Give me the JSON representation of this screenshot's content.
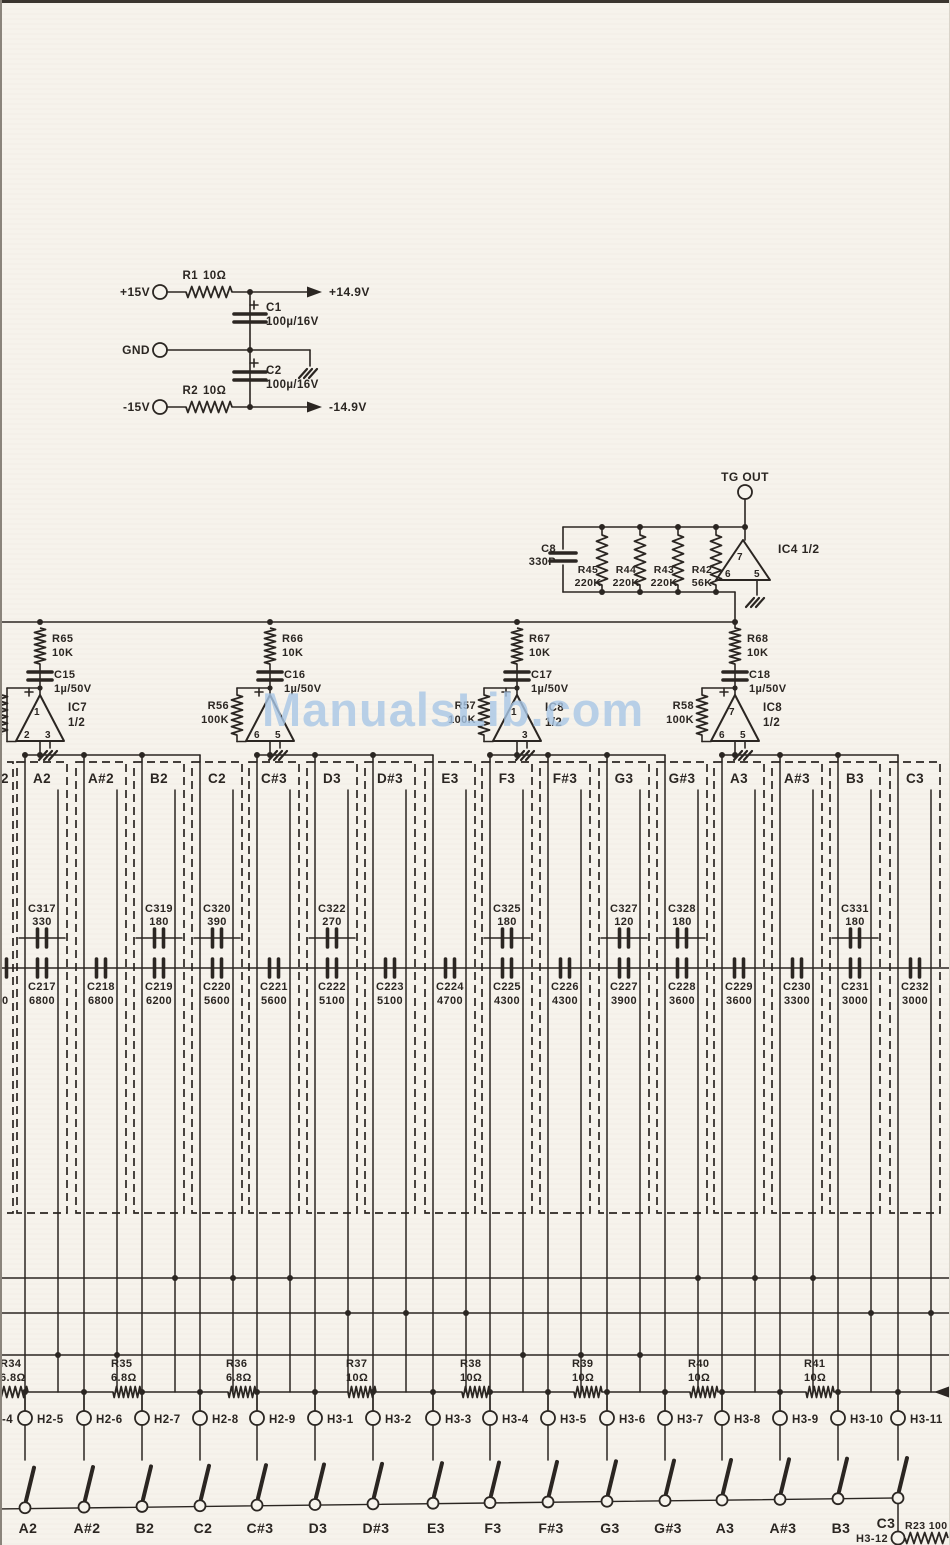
{
  "watermark": {
    "text": "ManualsLib.com"
  },
  "colors": {
    "ink": "#2b2622",
    "paper": "#f6f3ec",
    "watermark": "#a9c7e6"
  },
  "power": {
    "vin_pos": "+15V",
    "vin_gnd": "GND",
    "vin_neg": "-15V",
    "r1_name": "R1",
    "r1_value": "10Ω",
    "r2_name": "R2",
    "r2_value": "10Ω",
    "c1_name": "C1",
    "c1_value": "100µ/16V",
    "c2_name": "C2",
    "c2_value": "100µ/16V",
    "vout_pos": "+14.9V",
    "vout_neg": "-14.9V"
  },
  "tg": {
    "out": "TG OUT",
    "ic": "IC4 1/2",
    "pin_top": "7",
    "pin_bl": "6",
    "pin_br": "5",
    "c8_name": "C8",
    "c8_value": "330P",
    "resistors": [
      [
        "R45",
        "220K"
      ],
      [
        "R44",
        "220K"
      ],
      [
        "R43",
        "220K"
      ],
      [
        "R42",
        "56K"
      ]
    ]
  },
  "stages": [
    {
      "r": "R65",
      "rv": "10K",
      "c": "C15",
      "cv": "1µ/50V",
      "ic": "IC7",
      "half": "1/2",
      "pins": {
        "top": "1",
        "bl": "2",
        "br": "3"
      }
    },
    {
      "r": "R66",
      "rv": "10K",
      "c": "C16",
      "cv": "1µ/50V",
      "fb": "R56",
      "fbv": "100K",
      "pins": {
        "bl": "6",
        "br": "5"
      }
    },
    {
      "r": "R67",
      "rv": "10K",
      "c": "C17",
      "cv": "1µ/50V",
      "fb": "R57",
      "fbv": "100K",
      "ic": "IC8",
      "half": "1/2",
      "pins": {
        "top": "1",
        "br": "3"
      }
    },
    {
      "r": "R68",
      "rv": "10K",
      "c": "C18",
      "cv": "1µ/50V",
      "fb": "R58",
      "fbv": "100K",
      "ic": "IC8",
      "half": "1/2",
      "pins": {
        "top": "7",
        "bl": "6",
        "br": "5"
      }
    }
  ],
  "partial": {
    "note": "2",
    "bottom_value": "0"
  },
  "columns": [
    {
      "note": "A2",
      "top": [
        "C317",
        "330"
      ],
      "bottom": [
        "C217",
        "6800"
      ]
    },
    {
      "note": "A#2",
      "bottom": [
        "C218",
        "6800"
      ]
    },
    {
      "note": "B2",
      "top": [
        "C319",
        "180"
      ],
      "bottom": [
        "C219",
        "6200"
      ]
    },
    {
      "note": "C2",
      "top": [
        "C320",
        "390"
      ],
      "bottom": [
        "C220",
        "5600"
      ]
    },
    {
      "note": "C#3",
      "bottom": [
        "C221",
        "5600"
      ]
    },
    {
      "note": "D3",
      "top": [
        "C322",
        "270"
      ],
      "bottom": [
        "C222",
        "5100"
      ]
    },
    {
      "note": "D#3",
      "bottom": [
        "C223",
        "5100"
      ]
    },
    {
      "note": "E3",
      "bottom": [
        "C224",
        "4700"
      ]
    },
    {
      "note": "F3",
      "top": [
        "C325",
        "180"
      ],
      "bottom": [
        "C225",
        "4300"
      ]
    },
    {
      "note": "F#3",
      "bottom": [
        "C226",
        "4300"
      ]
    },
    {
      "note": "G3",
      "top": [
        "C327",
        "120"
      ],
      "bottom": [
        "C227",
        "3900"
      ]
    },
    {
      "note": "G#3",
      "top": [
        "C328",
        "180"
      ],
      "bottom": [
        "C228",
        "3600"
      ]
    },
    {
      "note": "A3",
      "bottom": [
        "C229",
        "3600"
      ]
    },
    {
      "note": "A#3",
      "bottom": [
        "C230",
        "3300"
      ]
    },
    {
      "note": "B3",
      "top": [
        "C331",
        "180"
      ],
      "bottom": [
        "C231",
        "3000"
      ]
    },
    {
      "note": "C3",
      "bottom": [
        "C232",
        "3000"
      ]
    }
  ],
  "bus_resistors": [
    [
      "R34",
      "6.8Ω"
    ],
    [
      "R35",
      "6.8Ω"
    ],
    [
      "R36",
      "6.8Ω"
    ],
    [
      "R37",
      "10Ω"
    ],
    [
      "R38",
      "10Ω"
    ],
    [
      "R39",
      "10Ω"
    ],
    [
      "R40",
      "10Ω"
    ],
    [
      "R41",
      "10Ω"
    ]
  ],
  "connectors": {
    "partial": "-4",
    "items": [
      "H2-5",
      "H2-6",
      "H2-7",
      "H2-8",
      "H2-9",
      "H3-1",
      "H3-2",
      "H3-3",
      "H3-4",
      "H3-5",
      "H3-6",
      "H3-7",
      "H3-8",
      "H3-9",
      "H3-10",
      "H3-11"
    ]
  },
  "switches": [
    "A2",
    "A#2",
    "B2",
    "C2",
    "C#3",
    "D3",
    "D#3",
    "E3",
    "F3",
    "F#3",
    "G3",
    "G#3",
    "A3",
    "A#3",
    "B3",
    "C3"
  ],
  "corner": {
    "connector": "H3-12",
    "resistor": "R23 100"
  }
}
